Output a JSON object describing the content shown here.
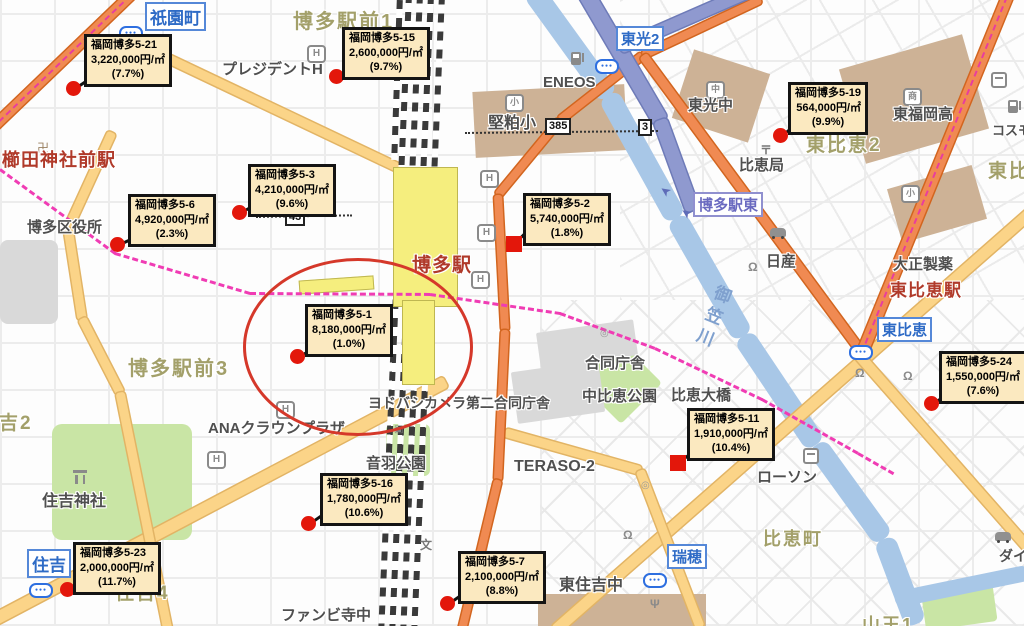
{
  "map": {
    "unit_note": "円/㎡",
    "callouts": [
      {
        "id": "福岡博多5-21",
        "price": "3,220,000円/㎡",
        "rate": "(7.7%)",
        "marker": "circle",
        "geo": {
          "bx": 84,
          "by": 34,
          "mx": 74,
          "my": 89,
          "la": -34,
          "ll": 19
        }
      },
      {
        "id": "福岡博多5-15",
        "price": "2,600,000円/㎡",
        "rate": "(9.7%)",
        "marker": "circle",
        "geo": {
          "bx": 342,
          "by": 27,
          "mx": 337,
          "my": 77,
          "la": -39,
          "ll": 19
        }
      },
      {
        "id": "福岡博多5-19",
        "price": "564,000円/㎡",
        "rate": "(9.9%)",
        "marker": "circle",
        "geo": {
          "bx": 788,
          "by": 82,
          "mx": 781,
          "my": 136,
          "la": -38,
          "ll": 18
        }
      },
      {
        "id": "福岡博多5-3",
        "price": "4,210,000円/㎡",
        "rate": "(9.6%)",
        "marker": "circle",
        "geo": {
          "bx": 248,
          "by": 164,
          "mx": 240,
          "my": 213,
          "la": -30,
          "ll": 14
        }
      },
      {
        "id": "福岡博多5-6",
        "price": "4,920,000円/㎡",
        "rate": "(2.3%)",
        "marker": "circle",
        "geo": {
          "bx": 128,
          "by": 194,
          "mx": 118,
          "my": 245,
          "la": -25,
          "ll": 15
        }
      },
      {
        "id": "福岡博多5-2",
        "price": "5,740,000円/㎡",
        "rate": "(1.8%)",
        "marker": "square",
        "geo": {
          "bx": 523,
          "by": 193,
          "mx": 514,
          "my": 244,
          "la": -45,
          "ll": 17
        }
      },
      {
        "id": "福岡博多5-1",
        "price": "8,180,000円/㎡",
        "rate": "(1.0%)",
        "marker": "circle",
        "geo": {
          "bx": 305,
          "by": 304,
          "mx": 298,
          "my": 357,
          "la": -30,
          "ll": 14
        }
      },
      {
        "id": "福岡博多5-24",
        "price": "1,550,000円/㎡",
        "rate": "(7.6%)",
        "marker": "circle",
        "geo": {
          "bx": 939,
          "by": 351,
          "mx": 932,
          "my": 404,
          "la": -33,
          "ll": 15
        }
      },
      {
        "id": "福岡博多5-11",
        "price": "1,910,000円/㎡",
        "rate": "(10.4%)",
        "marker": "square",
        "geo": {
          "bx": 687,
          "by": 408,
          "mx": 678,
          "my": 463,
          "la": -38,
          "ll": 18
        }
      },
      {
        "id": "福岡博多5-16",
        "price": "1,780,000円/㎡",
        "rate": "(10.6%)",
        "marker": "circle",
        "geo": {
          "bx": 320,
          "by": 473,
          "mx": 309,
          "my": 524,
          "la": -35,
          "ll": 16
        }
      },
      {
        "id": "福岡博多5-23",
        "price": "2,000,000円/㎡",
        "rate": "(11.7%)",
        "marker": "circle",
        "geo": {
          "bx": 73,
          "by": 542,
          "mx": 68,
          "my": 590,
          "la": -10,
          "ll": 12
        }
      },
      {
        "id": "福岡博多5-7",
        "price": "2,100,000円/㎡",
        "rate": "(8.8%)",
        "marker": "circle",
        "geo": {
          "bx": 458,
          "by": 551,
          "mx": 448,
          "my": 604,
          "la": -35,
          "ll": 17
        }
      }
    ],
    "station_badges": [
      {
        "label": "祇園町",
        "style": "blue",
        "x": 145,
        "y": 2,
        "fs": 17
      },
      {
        "label": "東光2",
        "style": "blue",
        "x": 616,
        "y": 26,
        "fs": 15
      },
      {
        "label": "博多駅東",
        "style": "purple",
        "x": 693,
        "y": 192,
        "fs": 15
      },
      {
        "label": "東比恵",
        "style": "blue",
        "x": 877,
        "y": 317,
        "fs": 15
      },
      {
        "label": "瑞穂",
        "style": "blue",
        "x": 667,
        "y": 544,
        "fs": 15
      },
      {
        "label": "住吉",
        "style": "blue",
        "x": 27,
        "y": 549,
        "fs": 17
      }
    ],
    "station_names": [
      {
        "text": "櫛田神社前駅",
        "x": 2,
        "y": 146,
        "fs": 18
      },
      {
        "text": "博多駅",
        "x": 412,
        "y": 250,
        "fs": 19
      },
      {
        "text": "東比恵駅",
        "x": 890,
        "y": 276,
        "fs": 17
      }
    ],
    "area_labels": [
      {
        "text": "博多駅前1",
        "x": 293,
        "y": 5,
        "fs": 20
      },
      {
        "text": "博多駅前3",
        "x": 128,
        "y": 352,
        "fs": 20
      },
      {
        "text": "東比恵2",
        "x": 806,
        "y": 130,
        "fs": 19
      },
      {
        "text": "東比恵",
        "x": 988,
        "y": 156,
        "fs": 19
      },
      {
        "text": "住吉2",
        "x": -22,
        "y": 408,
        "fs": 19
      },
      {
        "text": "住吉4",
        "x": 115,
        "y": 578,
        "fs": 19
      },
      {
        "text": "比恵町",
        "x": 763,
        "y": 525,
        "fs": 18
      },
      {
        "text": "山王1",
        "x": 862,
        "y": 611,
        "fs": 18
      }
    ],
    "poi_labels": [
      {
        "text": "プレジデントH",
        "x": 222,
        "y": 58,
        "fs": 15
      },
      {
        "text": "ENEOS",
        "x": 543,
        "y": 74,
        "fs": 15
      },
      {
        "text": "堅粕小",
        "x": 488,
        "y": 109,
        "fs": 16
      },
      {
        "text": "東光中",
        "x": 688,
        "y": 94,
        "fs": 15
      },
      {
        "text": "比恵局",
        "x": 739,
        "y": 154,
        "fs": 15
      },
      {
        "text": "東福岡高",
        "x": 893,
        "y": 103,
        "fs": 15
      },
      {
        "text": "コスモ",
        "x": 992,
        "y": 120,
        "fs": 13
      },
      {
        "text": "博多区役所",
        "x": 27,
        "y": 216,
        "fs": 15
      },
      {
        "text": "日産",
        "x": 766,
        "y": 250,
        "fs": 15
      },
      {
        "text": "大正製薬",
        "x": 893,
        "y": 253,
        "fs": 15
      },
      {
        "text": "合同庁舎",
        "x": 585,
        "y": 352,
        "fs": 15
      },
      {
        "text": "中比恵公園",
        "x": 582,
        "y": 385,
        "fs": 15
      },
      {
        "text": "比恵大橋",
        "x": 671,
        "y": 384,
        "fs": 15
      },
      {
        "text": "ヨドバシカメラ第二合同庁舎",
        "x": 368,
        "y": 393,
        "fs": 14
      },
      {
        "text": "音羽公園",
        "x": 366,
        "y": 452,
        "fs": 15
      },
      {
        "text": "ANAクラウンプラザ",
        "x": 208,
        "y": 417,
        "fs": 15
      },
      {
        "text": "住吉神社",
        "x": 42,
        "y": 487,
        "fs": 16
      },
      {
        "text": "TERASO-2",
        "x": 514,
        "y": 458,
        "fs": 16
      },
      {
        "text": "ローソン",
        "x": 757,
        "y": 466,
        "fs": 15
      },
      {
        "text": "東住吉中",
        "x": 559,
        "y": 571,
        "fs": 16
      },
      {
        "text": "ダイハツ",
        "x": 999,
        "y": 546,
        "fs": 14
      },
      {
        "text": "ファンビ寺中",
        "x": 281,
        "y": 604,
        "fs": 15
      }
    ],
    "river_name": {
      "text": "御笠川",
      "x": 699,
      "y": 283
    },
    "route_shields": [
      {
        "num": "385",
        "x": 545,
        "y": 118
      },
      {
        "num": "3",
        "x": 638,
        "y": 119
      },
      {
        "num": "43",
        "x": 285,
        "y": 209
      }
    ],
    "icons": [
      {
        "name": "hotel-icon",
        "glyph": "H",
        "x": 307,
        "y": 45
      },
      {
        "name": "hotel-icon",
        "glyph": "H",
        "x": 480,
        "y": 170
      },
      {
        "name": "hotel-icon",
        "glyph": "H",
        "x": 477,
        "y": 224
      },
      {
        "name": "hotel-icon",
        "glyph": "H",
        "x": 471,
        "y": 271
      },
      {
        "name": "hotel-icon",
        "glyph": "H",
        "x": 276,
        "y": 401
      },
      {
        "name": "hotel-icon",
        "glyph": "H",
        "x": 207,
        "y": 451
      },
      {
        "name": "gas-station-icon",
        "x": 571,
        "y": 52
      },
      {
        "name": "gas-station-icon",
        "x": 1008,
        "y": 100
      },
      {
        "name": "convenience-store-icon",
        "x": 991,
        "y": 72
      },
      {
        "name": "convenience-store-icon",
        "x": 803,
        "y": 448
      },
      {
        "name": "post-office-icon",
        "glyph": "〒",
        "x": 760,
        "y": 141
      },
      {
        "name": "school-badge-icon",
        "glyph": "小",
        "x": 505,
        "y": 94
      },
      {
        "name": "school-badge-icon",
        "glyph": "中",
        "x": 706,
        "y": 81
      },
      {
        "name": "school-badge-icon",
        "glyph": "商",
        "x": 903,
        "y": 88
      },
      {
        "name": "school-badge-icon",
        "glyph": "小",
        "x": 901,
        "y": 185
      },
      {
        "name": "temple-icon",
        "glyph": "卍",
        "x": 37,
        "y": 139
      },
      {
        "name": "shrine-torii-icon",
        "x": 73,
        "y": 470
      },
      {
        "name": "school-symbol-icon",
        "glyph": "文",
        "x": 420,
        "y": 536
      },
      {
        "name": "traffic-light-icon",
        "x": 119,
        "y": 26
      },
      {
        "name": "traffic-light-icon",
        "x": 595,
        "y": 59
      },
      {
        "name": "traffic-light-icon",
        "x": 849,
        "y": 345
      },
      {
        "name": "traffic-light-icon",
        "x": 29,
        "y": 583
      },
      {
        "name": "traffic-light-icon",
        "x": 643,
        "y": 573
      },
      {
        "name": "car-dealer-icon",
        "x": 770,
        "y": 228
      },
      {
        "name": "car-dealer-icon",
        "x": 995,
        "y": 532
      },
      {
        "name": "restaurant-icon",
        "glyph": "Ψ",
        "x": 650,
        "y": 597
      },
      {
        "name": "shop-icon",
        "glyph": "Ω",
        "x": 748,
        "y": 260
      },
      {
        "name": "shop-icon",
        "glyph": "Ω",
        "x": 855,
        "y": 366
      },
      {
        "name": "shop-icon",
        "glyph": "Ω",
        "x": 903,
        "y": 369
      },
      {
        "name": "shop-icon",
        "glyph": "Ω",
        "x": 623,
        "y": 528
      },
      {
        "name": "landmark-icon",
        "glyph": "◎",
        "x": 641,
        "y": 480
      },
      {
        "name": "landmark-icon",
        "glyph": "◎",
        "x": 600,
        "y": 328
      },
      {
        "name": "park-monument-icon",
        "glyph": "▣",
        "x": 394,
        "y": 424
      },
      {
        "name": "ramp-arrow-icon",
        "glyph": "➤",
        "x": 660,
        "y": 183
      },
      {
        "name": "ramp-arrow-icon",
        "glyph": "➤",
        "x": 681,
        "y": 205
      }
    ],
    "annotation_ellipse": {
      "x": 243,
      "y": 258,
      "w": 224,
      "h": 172,
      "color": "#D5382A"
    },
    "colors": {
      "callout_bg": "#FBE9C0",
      "marker_red": "#E3170B",
      "ellipse_red": "#D5382A",
      "road_yellow": "#FBD488",
      "road_orange": "#F08A52",
      "expressway_blue": "#8F99CF",
      "river_blue": "#A8C7E7",
      "park_green": "#C9E5A5",
      "building_brown": "#CDB296",
      "area_label": "#A3A06A",
      "station_red": "#B03A2A",
      "badge_blue": "#2E6BC6",
      "subway_magenta": "#F03CB4"
    }
  }
}
